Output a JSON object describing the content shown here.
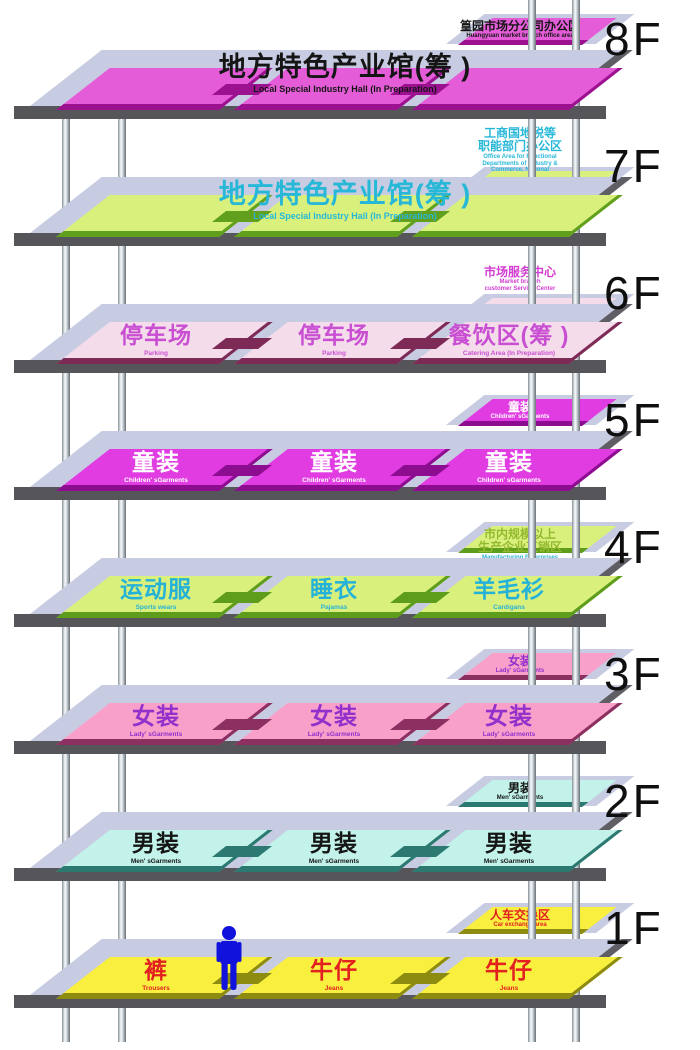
{
  "diagram_title": "Market building floor directory",
  "structure": {
    "background": "#ffffff",
    "slab_top_color": "#c8cce2",
    "slab_edge_color": "#55555a",
    "pole_color": "#b7bfc4",
    "floor_number_color": "#0f0f0f",
    "person_color": "#1113dc"
  },
  "floors": [
    {
      "label": "8F",
      "top": "#e55cd8",
      "edge": "#9b1190",
      "banner": {
        "zh": "地方特色产业馆(筹 )",
        "en": "Local Special Industry Hall (In Preparation)",
        "color": "#151515"
      },
      "badge": {
        "zh": [
          "篁园市场分公司办公区"
        ],
        "en": [
          "Huangyuan market branch office area"
        ],
        "color": "#151515",
        "style": "on"
      }
    },
    {
      "label": "7F",
      "top": "#d9f07d",
      "edge": "#61a01c",
      "banner": {
        "zh": "地方特色产业馆(筹 )",
        "en": "Local Special Industry Hall (In Preparation)",
        "color": "#27b8d8"
      },
      "badge": {
        "zh": [
          "工商国地税等",
          "职能部门办公区"
        ],
        "en": [
          "Office Area for Functional",
          "Departments of Industry &",
          "Commerce, National"
        ],
        "color": "#27b8d8",
        "style": "float"
      }
    },
    {
      "label": "6F",
      "top": "#f5dcea",
      "edge": "#7d2a57",
      "labelColor": "#c94fd2",
      "sections": [
        {
          "zh": "停车场",
          "en": "Parking"
        },
        {
          "zh": "停车场",
          "en": "Parking"
        },
        {
          "zh": "餐饮区(筹 )",
          "en": "Catering Area (In Preparation)"
        }
      ],
      "badge": {
        "zh": [
          "市场服务中心"
        ],
        "en": [
          "Market branch",
          "customer Service Center"
        ],
        "color": "#d23cd2",
        "style": "float"
      }
    },
    {
      "label": "5F",
      "top": "#e13ce2",
      "edge": "#8c0d90",
      "labelColor": "#ffffff",
      "sections": [
        {
          "zh": "童装",
          "en": "Children' sGarments"
        },
        {
          "zh": "童装",
          "en": "Children' sGarments"
        },
        {
          "zh": "童装",
          "en": "Children' sGarments"
        }
      ],
      "badge": {
        "zh": [
          "童装"
        ],
        "en": [
          "Children' sGarments"
        ],
        "color": "#ffffff",
        "style": "on"
      }
    },
    {
      "label": "4F",
      "top": "#d9f07d",
      "edge": "#5e9d1b",
      "labelColor": "#25b2d8",
      "sections": [
        {
          "zh": "运动服",
          "en": "Sports wears"
        },
        {
          "zh": "睡衣",
          "en": "Pajamas"
        },
        {
          "zh": "羊毛衫",
          "en": "Cardigans"
        }
      ],
      "badge": {
        "zh": [
          "市内规模以上",
          "生产企业直销区"
        ],
        "en": [
          "Manufacturing Enterprises",
          "Direct Sale Area"
        ],
        "color": "#93b92f",
        "enColor": "#27b0cc",
        "style": "on"
      }
    },
    {
      "label": "3F",
      "top": "#f9a0ca",
      "edge": "#8b3060",
      "labelColor": "#9230cc",
      "sections": [
        {
          "zh": "女装",
          "en": "Lady' sGarments"
        },
        {
          "zh": "女装",
          "en": "Lady' sGarments"
        },
        {
          "zh": "女装",
          "en": "Lady' sGarments"
        }
      ],
      "badge": {
        "zh": [
          "女装"
        ],
        "en": [
          "Lady' sGarments"
        ],
        "color": "#9230cc",
        "style": "on"
      }
    },
    {
      "label": "2F",
      "top": "#c2f2e9",
      "edge": "#2c7971",
      "labelColor": "#151515",
      "sections": [
        {
          "zh": "男装",
          "en": "Men' sGarments"
        },
        {
          "zh": "男装",
          "en": "Men' sGarments"
        },
        {
          "zh": "男装",
          "en": "Men' sGarments"
        }
      ],
      "badge": {
        "zh": [
          "男装"
        ],
        "en": [
          "Men' sGarments"
        ],
        "color": "#151515",
        "style": "on"
      }
    },
    {
      "label": "1F",
      "top": "#f8ef3e",
      "edge": "#8e8c10",
      "labelColor": "#e22020",
      "sections": [
        {
          "zh": "裤",
          "en": "Trousers"
        },
        {
          "zh": "牛仔",
          "en": "Jeans"
        },
        {
          "zh": "牛仔",
          "en": "Jeans"
        }
      ],
      "badge": {
        "zh": [
          "人车交换区"
        ],
        "en": [
          "Car exchange area"
        ],
        "color": "#e22020",
        "style": "on"
      },
      "person": true
    }
  ]
}
